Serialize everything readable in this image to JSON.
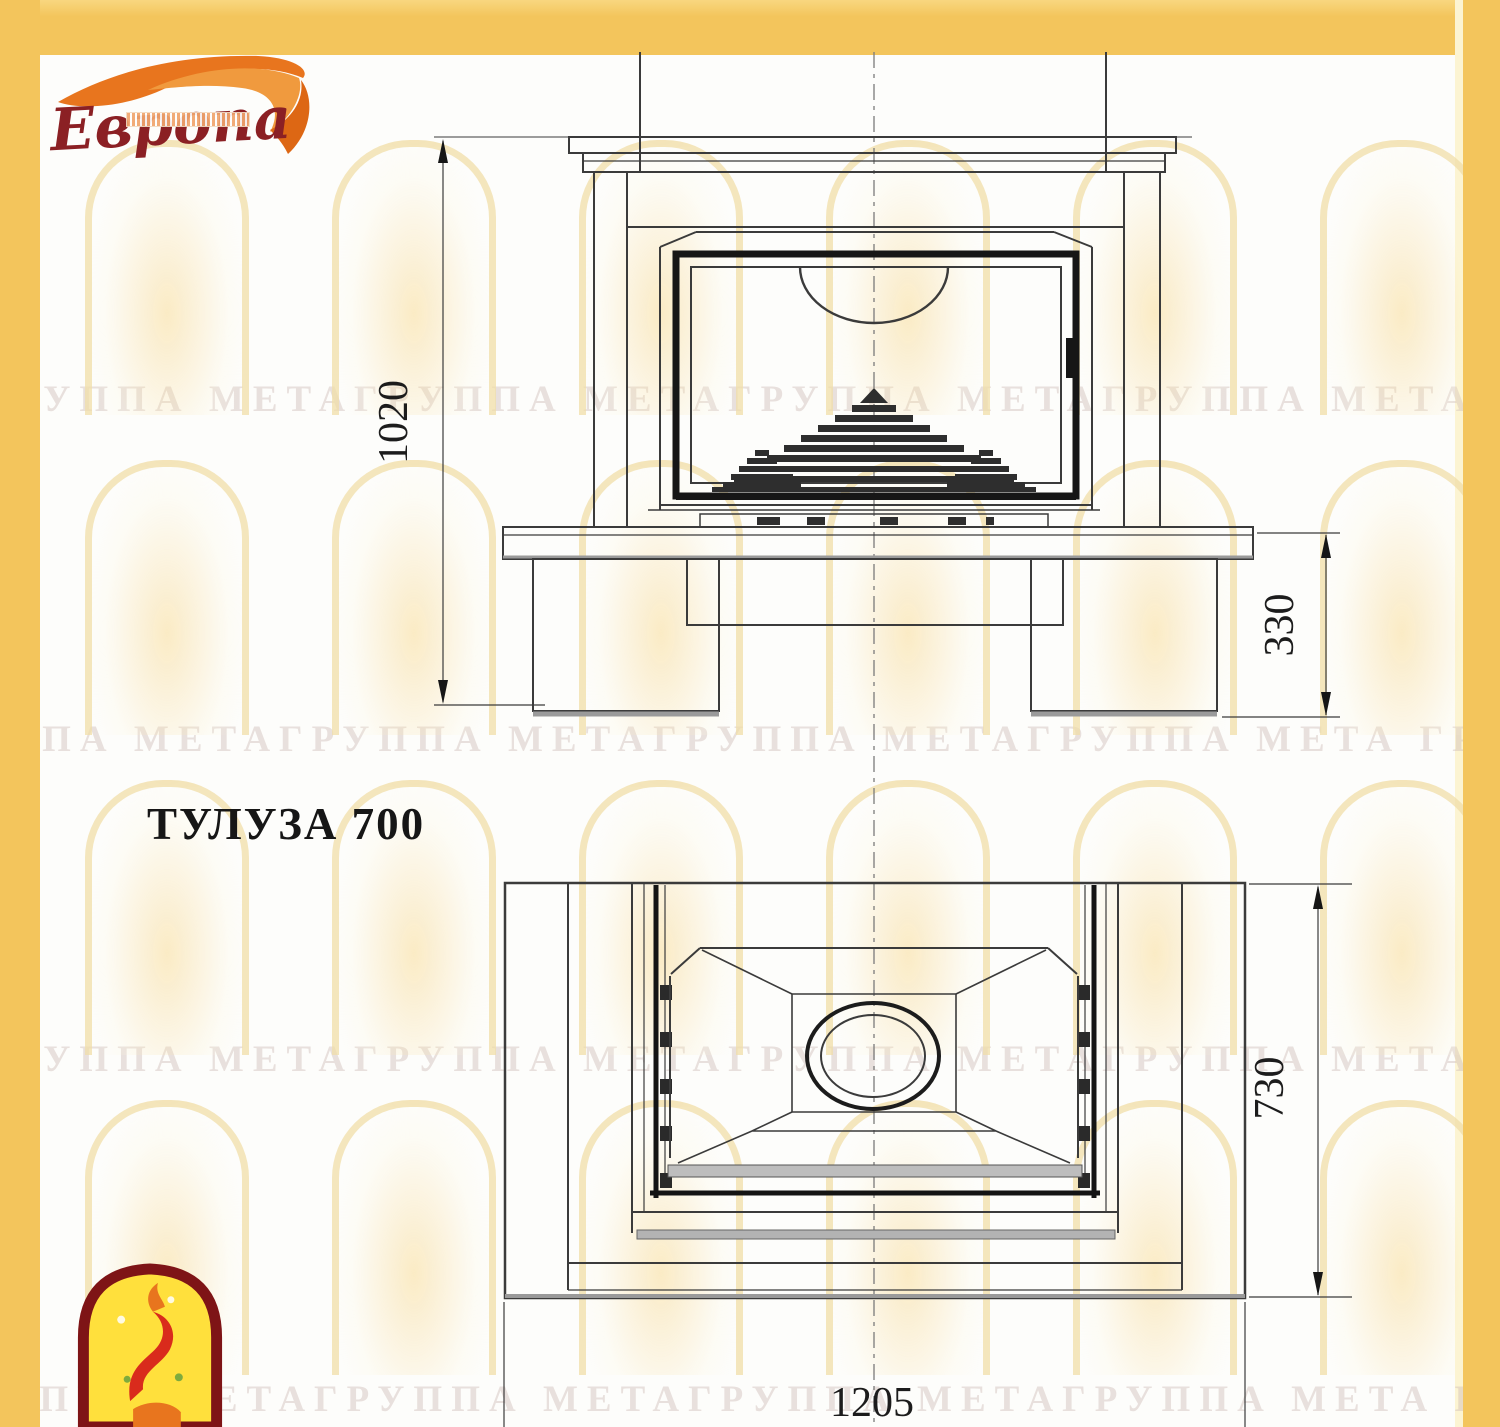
{
  "page": {
    "title_label": "ТУЛУЗА 700"
  },
  "logo": {
    "brand_text": "Европа"
  },
  "watermark": {
    "row_text": "ГРУППА МЕТАГРУППА МЕТАГРУППА МЕТАГРУППА МЕТА ГРУППА МЕТАГРУППА МЕТА"
  },
  "front_view": {
    "view": "front elevation of fireplace",
    "dim_overall_height": "1020",
    "dim_plinth_height": "330"
  },
  "plan_view": {
    "view": "top plan of fireplace",
    "dim_depth": "730",
    "dim_width": "1205"
  },
  "colors": {
    "frame": "#F3C55C",
    "logo_red": "#8B2024",
    "flame_orange": "#E8751E",
    "emblem_yellow": "#FFE03C",
    "emblem_border": "#7E1416",
    "line_dark": "#2B2B2B",
    "watermark_text": "#CDBAB4"
  }
}
